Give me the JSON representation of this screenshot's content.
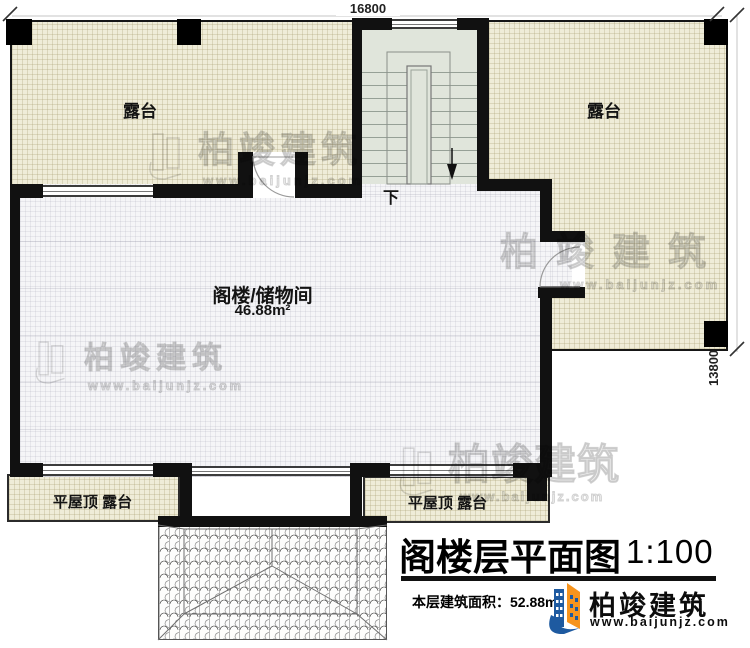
{
  "dimensions": {
    "width_top": "16800",
    "height_right": "13800"
  },
  "labels": {
    "terrace_left": "露台",
    "terrace_right": "露台",
    "attic_name": "阁楼/储物间",
    "attic_area": "46.88m²",
    "flat_roof_left": "平屋顶 露台",
    "flat_roof_right": "平屋顶 露台",
    "stair_down": "下"
  },
  "title_block": {
    "title": "阁楼层平面图",
    "scale": "1:100",
    "floor_area": "本层建筑面积：52.88m²",
    "brand": "柏竣建筑",
    "website": "www.baijunjz.com"
  },
  "watermark": {
    "brand": "柏竣建筑",
    "website": "www.baijunjz.com"
  },
  "colors": {
    "wall": "#111111",
    "terrace_fill": "#efecd8",
    "room_fill": "#f5f5f7",
    "stair_fill": "#e0e5db",
    "logo_blue": "#1e5aa0",
    "logo_orange": "#f7941d"
  }
}
